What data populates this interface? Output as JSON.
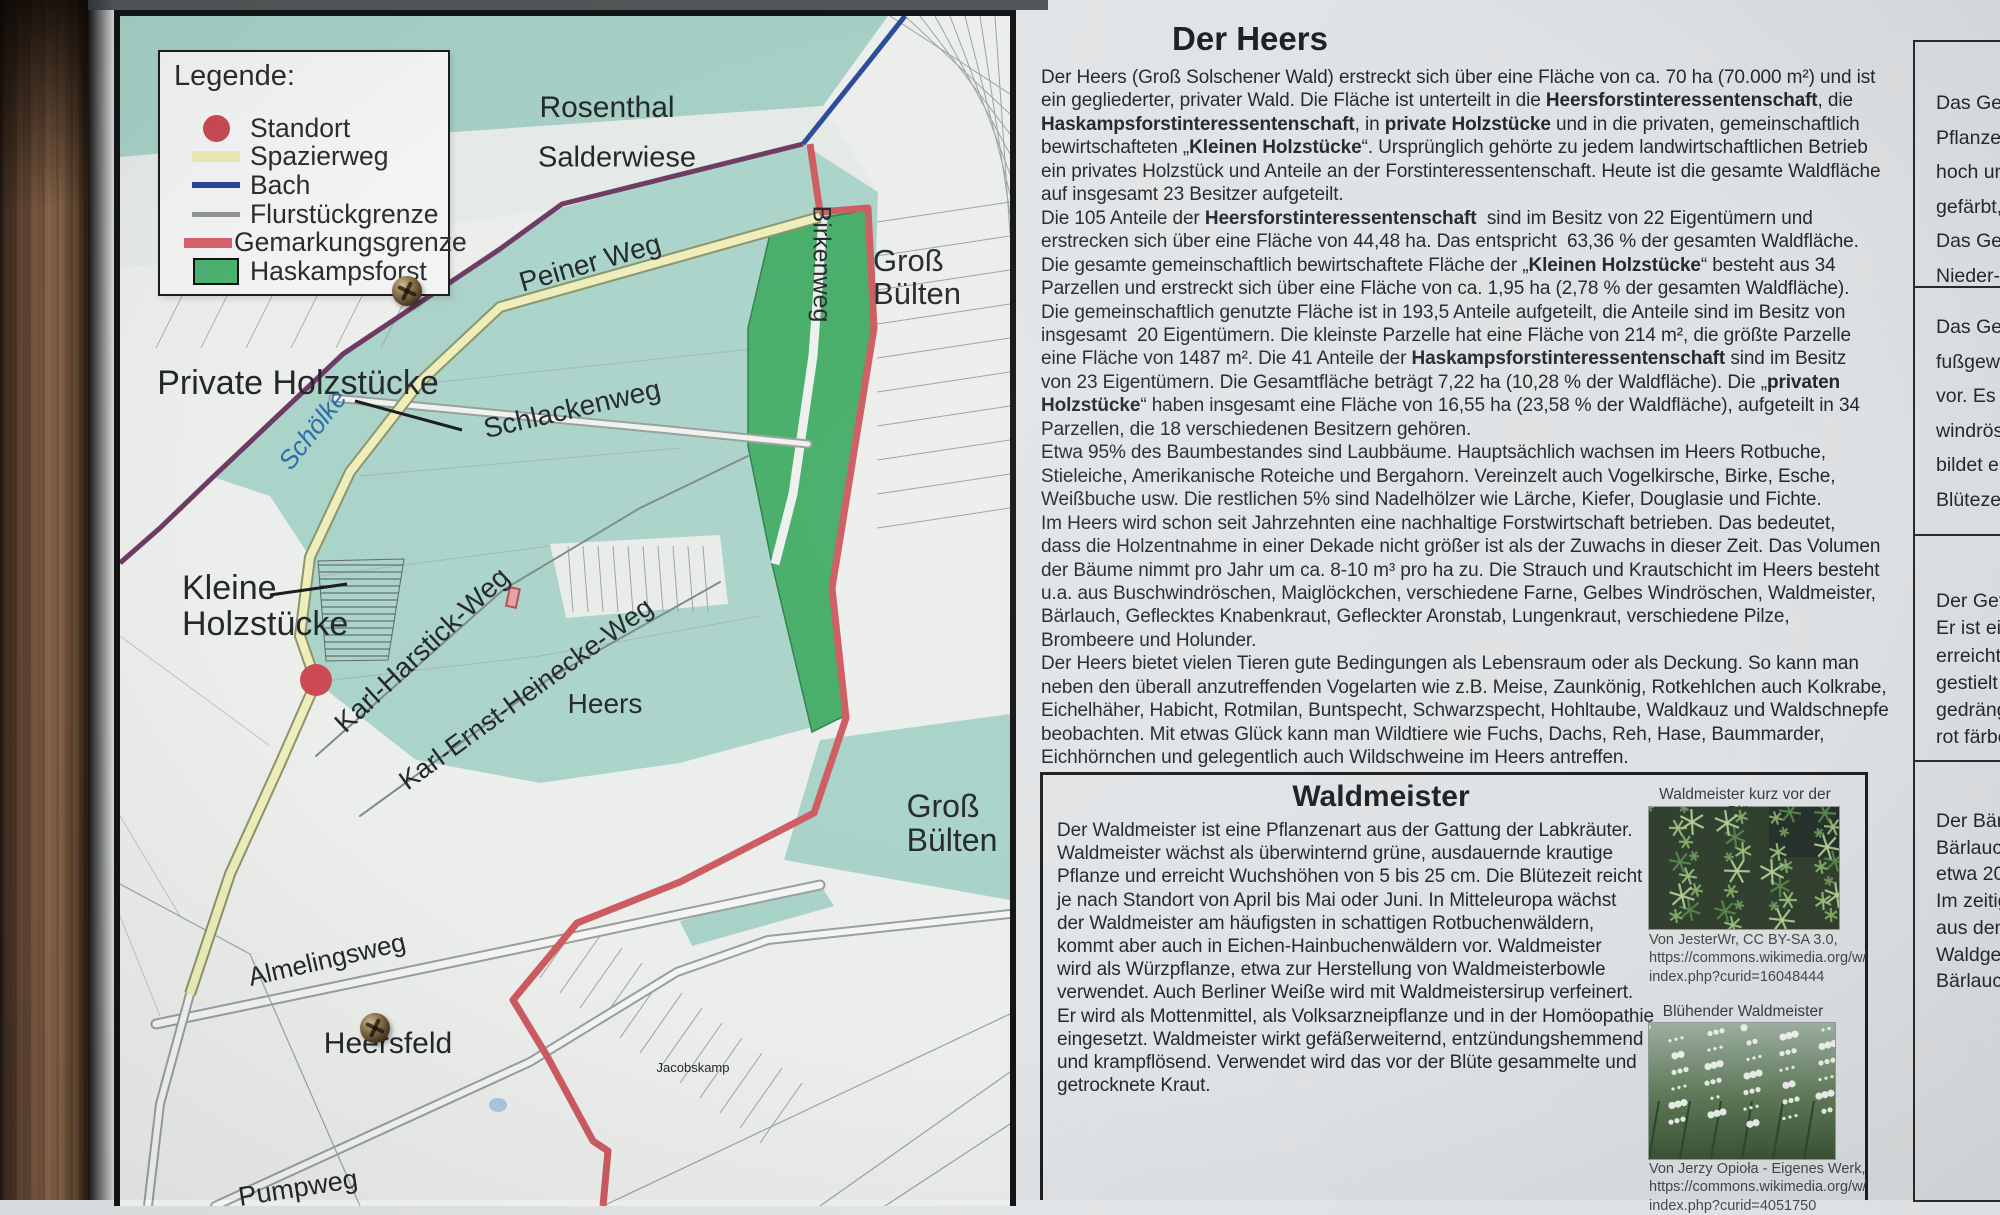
{
  "board": {
    "title": "Der Heers",
    "article_lines": [
      "Der Heers (Groß Solschener Wald) erstreckt sich über eine Fläche von ca. 70 ha (70.000 m²) und ist",
      "ein gegliederter, privater Wald. Die Fläche ist unterteilt in die **Heersforstinteressentenschaft**, die",
      "**Haskampsforstinteressentenschaft**, in **private Holzstücke** und in die privaten, gemeinschaftlich",
      "bewirtschafteten „**Kleinen Holzstücke**“. Ursprünglich gehörte zu jedem landwirtschaftlichen Betrieb",
      "ein privates Holzstück und Anteile an der Forstinteressentenschaft. Heute ist die gesamte Waldfläche",
      "auf insgesamt 23 Besitzer aufgeteilt.",
      "Die 105 Anteile der **Heersforstinteressentenschaft**  sind im Besitz von 22 Eigentümern und",
      "erstrecken sich über eine Fläche von 44,48 ha. Das entspricht  63,36 % der gesamten Waldfläche.",
      "Die gesamte gemeinschaftlich bewirtschaftete Fläche der „**Kleinen Holzstücke**“ besteht aus 34",
      "Parzellen und erstreckt sich über eine Fläche von ca. 1,95 ha (2,78 % der gesamten Waldfläche).",
      "Die gemeinschaftlich genutzte Fläche ist in 193,5 Anteile aufgeteilt, die Anteile sind im Besitz von",
      "insgesamt  20 Eigentümern. Die kleinste Parzelle hat eine Fläche von 214 m², die größte Parzelle",
      "eine Fläche von 1487 m². Die 41 Anteile der **Haskampsforstinteressentenschaft** sind im Besitz",
      "von 23 Eigentümern. Die Gesamtfläche beträgt 7,22 ha (10,28 % der Waldfläche). Die „**privaten**",
      "**Holzstücke**“ haben insgesamt eine Fläche von 16,55 ha (23,58 % der Waldfläche), aufgeteilt in 34",
      "Parzellen, die 18 verschiedenen Besitzern gehören.",
      "Etwa 95% des Baumbestandes sind Laubbäume. Hauptsächlich wachsen im Heers Rotbuche,",
      "Stieleiche, Amerikanische Roteiche und Bergahorn. Vereinzelt auch Vogelkirsche, Birke, Esche,",
      "Weißbuche usw. Die restlichen 5% sind Nadelhölzer wie Lärche, Kiefer, Douglasie und Fichte.",
      "Im Heers wird schon seit Jahrzehnten eine nachhaltige Forstwirtschaft betrieben. Das bedeutet,",
      "dass die Holzentnahme in einer Dekade nicht größer ist als der Zuwachs in dieser Zeit. Das Volumen",
      "der Bäume nimmt pro Jahr um ca. 8-10 m³ pro ha zu. Die Strauch und Krautschicht im Heers besteht",
      "u.a. aus Buschwindröschen, Maiglöckchen, verschiedene Farne, Gelbes Windröschen, Waldmeister,",
      "Bärlauch, Geflecktes Knabenkraut, Gefleckter Aronstab, Lungenkraut, verschiedene Pilze,",
      "Brombeere und Holunder.",
      "Der Heers bietet vielen Tieren gute Bedingungen als Lebensraum oder als Deckung. So kann man",
      "neben den überall anzutreffenden Vogelarten wie z.B. Meise, Zaunkönig, Rotkehlchen auch Kolkrabe,",
      "Eichelhäher, Habicht, Rotmilan, Buntspecht, Schwarzspecht, Hohltaube, Waldkauz und Waldschnepfe",
      "beobachten. Mit etwas Glück kann man Wildtiere wie Fuchs, Dachs, Reh, Hase, Baummarder,",
      "Eichhörnchen und gelegentlich auch Wildschweine im Heers antreffen."
    ]
  },
  "map": {
    "legend": {
      "title": "Legende:",
      "items": [
        {
          "label": "Standort",
          "swatch": "dot",
          "color": "#c74a54"
        },
        {
          "label": "Spazierweg",
          "swatch": "band",
          "color": "#e9ecb4"
        },
        {
          "label": "Bach",
          "swatch": "line6",
          "color": "#27479b"
        },
        {
          "label": "Flurstückgrenze",
          "swatch": "line5",
          "color": "#8f9598"
        },
        {
          "label": "Gemarkungsgrenze",
          "swatch": "band2",
          "color": "#d5626b"
        },
        {
          "label": "Haskampsforst",
          "swatch": "rect",
          "color": "#4cb170"
        }
      ]
    },
    "colors": {
      "forest_teal": "#aad3c9",
      "haskampsforst_green": "#46ad68",
      "spazierweg_yellow": "#edeebb",
      "bach_blue": "#2b4b9b",
      "gemarkungsgrenze_red": "#cd5b60",
      "boundary_purple": "#6d3a63",
      "parcel_gray": "#9aa3a1"
    },
    "labels": [
      {
        "text": "Rosenthal",
        "x": 487,
        "y": 92,
        "size": 30
      },
      {
        "text": "Salderwiese",
        "x": 497,
        "y": 142,
        "size": 29
      },
      {
        "text": "Peiner Weg",
        "x": 470,
        "y": 247,
        "rot": -16,
        "size": 28
      },
      {
        "lines": [
          "Groß",
          "Bülten"
        ],
        "x": 797,
        "y": 262,
        "size": 31
      },
      {
        "text": "Birkenweg",
        "x": 701,
        "y": 248,
        "rot": 90,
        "size": 25
      },
      {
        "text": "Private Holzstücke",
        "x": 178,
        "y": 367,
        "size": 34
      },
      {
        "text": "Schölke",
        "x": 193,
        "y": 414,
        "rot": -52,
        "size": 26,
        "color": "#2d6cab",
        "italic": true
      },
      {
        "text": "Schlackenweg",
        "x": 452,
        "y": 393,
        "rot": -13,
        "size": 28
      },
      {
        "lines": [
          "Kleine",
          "Holzstücke"
        ],
        "x": 62,
        "y": 590,
        "size": 34,
        "align": "left"
      },
      {
        "text": "Karl-Harstick-Weg",
        "x": 302,
        "y": 634,
        "rot": -43,
        "size": 28
      },
      {
        "text": "Karl-Ernst-Heinecke-Weg",
        "x": 406,
        "y": 678,
        "rot": -36,
        "size": 27
      },
      {
        "text": "Heers",
        "x": 485,
        "y": 688,
        "size": 28
      },
      {
        "lines": [
          "Groß",
          "Bülten"
        ],
        "x": 832,
        "y": 808,
        "size": 32
      },
      {
        "text": "Almelingsweg",
        "x": 207,
        "y": 944,
        "rot": -13,
        "size": 26
      },
      {
        "text": "Heersfeld",
        "x": 268,
        "y": 1028,
        "size": 30
      },
      {
        "text": "Jacobskamp",
        "x": 573,
        "y": 1052,
        "size": 13
      },
      {
        "text": "Pumpweg",
        "x": 178,
        "y": 1172,
        "rot": -9,
        "size": 27
      }
    ]
  },
  "waldmeister": {
    "title": "Waldmeister",
    "lines": [
      "Der Waldmeister ist eine Pflanzenart aus der Gattung der Labkräuter.",
      "Waldmeister wächst als überwinternd grüne, ausdauernde krautige",
      "Pflanze und erreicht Wuchshöhen von 5 bis 25 cm. Die Blütezeit reicht",
      "je nach Standort von April bis Mai oder Juni. In Mitteleuropa wächst",
      "der Waldmeister am häufigsten in schattigen Rotbuchenwäldern,",
      "kommt aber auch in Eichen-Hainbuchenwäldern vor. Waldmeister",
      "wird als Würzpflanze, etwa zur Herstellung von Waldmeisterbowle",
      "verwendet. Auch Berliner Weiße wird mit Waldmeistersirup verfeinert.",
      "Er wird als Mottenmittel, als Volksarzneipflanze und in der Homöopathie",
      "eingesetzt. Waldmeister wirkt gefäßerweiternd, entzündungshemmend",
      "und krampflösend. Verwendet wird das vor der Blüte gesammelte und",
      "getrocknete Kraut."
    ],
    "images": [
      {
        "caption": "Waldmeister kurz vor der Blüte",
        "credit_lines": [
          "Von JesterWr, CC BY-SA 3.0,",
          "https://commons.wikimedia.org/w/",
          "index.php?curid=16048444"
        ]
      },
      {
        "caption": "Blühender Waldmeister",
        "credit_lines": [
          "Von Jerzy Opioła - Eigenes Werk,",
          "https://commons.wikimedia.org/w/",
          "index.php?curid=4051750"
        ]
      }
    ]
  },
  "side_column": {
    "boxes": [
      {
        "lines": [
          "Das Ge",
          "Pflanze",
          "hoch un",
          "gefärbt,",
          "Das Ge",
          "Nieder-"
        ]
      },
      {
        "lines": [
          "Das Gel",
          "fußgewä",
          "vor. Es i",
          "windröse",
          "bildet ei",
          "Blütezei"
        ]
      },
      {
        "lines": [
          "Der Gefl",
          "Er ist ein",
          "erreicht.",
          "gestielt u",
          "gedrängt",
          "rot färbe"
        ]
      },
      {
        "lines": [
          "Der Bärla",
          "Bärlauch",
          "etwa 20",
          "Im zeitige",
          "aus dene",
          "Waldges",
          "Bärlauch"
        ]
      }
    ]
  }
}
